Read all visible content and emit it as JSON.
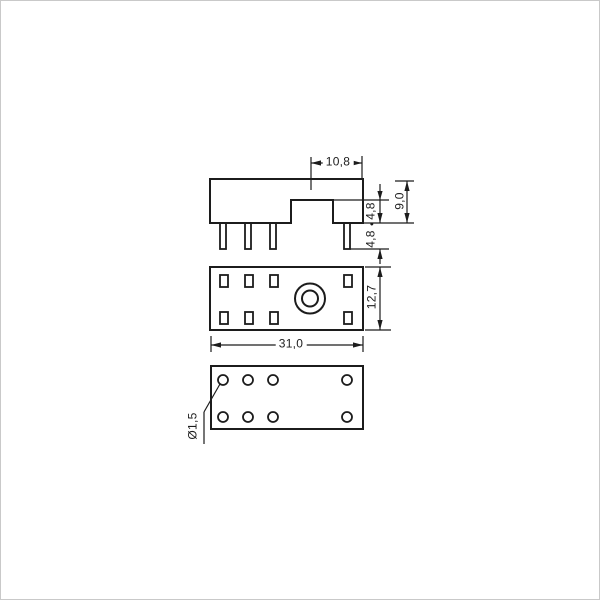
{
  "drawing": {
    "title": "relay-socket-dimension-drawing",
    "labels": {
      "top_width": "10,8",
      "overall_height": "9,0",
      "notch_height": "4,8",
      "separator_dot": "•",
      "pin_length": "4,8",
      "body_depth": "12,7",
      "body_width": "31,0",
      "hole_diameter": "Ø1,5"
    },
    "colors": {
      "line": "#1c1c1c",
      "background": "#ffffff",
      "border": "#c9c9c9"
    }
  }
}
